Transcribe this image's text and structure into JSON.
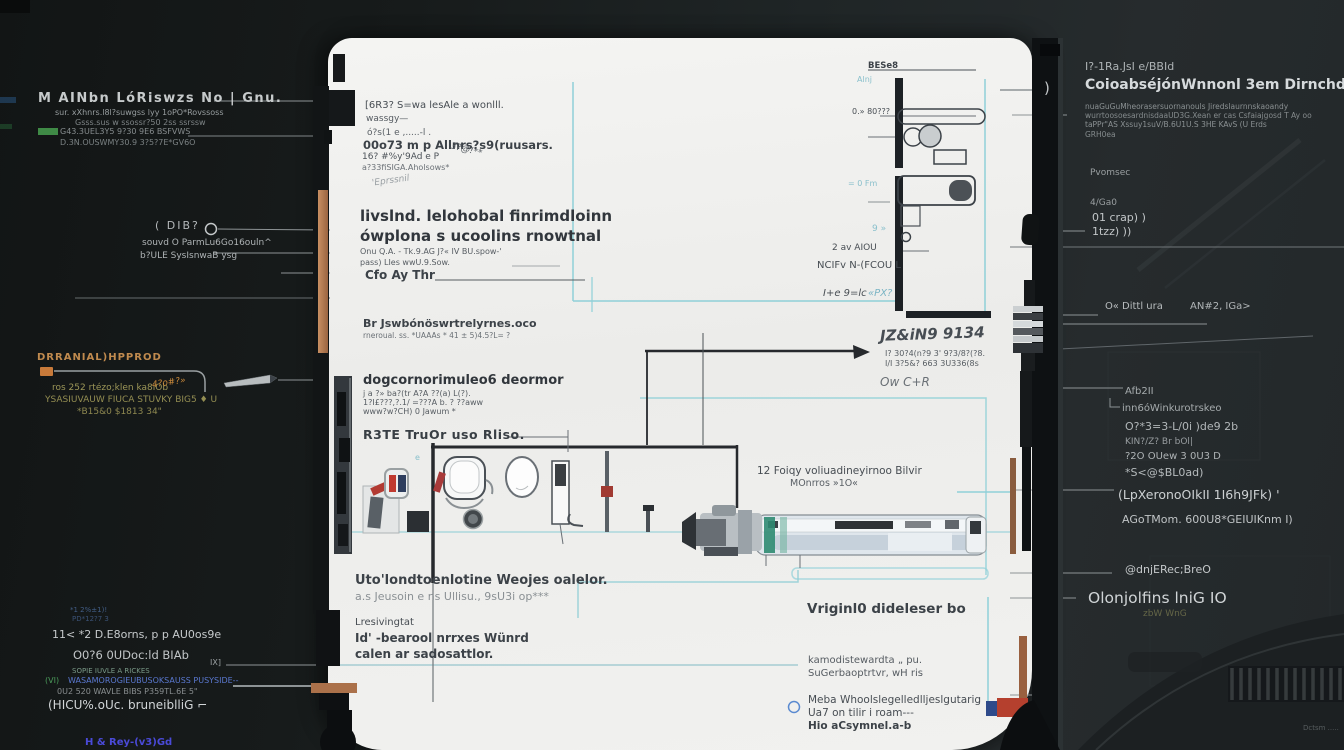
{
  "colors": {
    "background_dark": "#1a1e1f",
    "panel_white": "#f0f0ee",
    "cyan_accent": "#8fd0d8",
    "orange_accent": "#c87a3a",
    "copper": "#ab714a",
    "olive_text": "#948e52",
    "green_bar": "#3f8a46",
    "blue_link": "#5a78d0",
    "red_accent": "#b5402e",
    "blue_block": "#2e4a8a",
    "teal_machine": "#2f8b72"
  },
  "left": {
    "l1": "M AINbn LóRiswzs No | Gnu.",
    "l2a": "sur. xXhnrs.l8l?suwgss lyy 1oPO*Rovssoss",
    "l2b": "Gsss.sus w ssossr?50 2ss ssrssw",
    "l2c": "G43.3UEL3Y5 9?30 9E6 BSFVWS",
    "l2d": "D.3N.OUSWMY30.9 3?5?7E*GV6O",
    "l3": "( DIB?",
    "l4": "souvd O ParmLu6Go16ouln^",
    "l5": "b?ULE SysIsnwaB ysg",
    "l6": "DRRANIAL)HPPROD",
    "l8": "ros 252 rtézo;klen ka8iOb",
    "l8b": "4?o#?»",
    "l9": "YSASIUVAUW FIUCA STUVKY BIG5 ♦ U",
    "l10": "*B15&0 $1813 34\"",
    "l11a": "*1 2%±1)!",
    "l11b": "PD*12?7 3",
    "l12a": "11< *2 D.E8orns, p p AU0os9e",
    "l12b": "O0?6 0UDoc:ld BIAb",
    "l12c": "SOPIE IUVLE A RICKES",
    "l12d_prefix": "(VI)",
    "l12d": "WASAMOROGIEUBUSOKSAUSS PUSYSIDE--",
    "l12e": "0U2 520 WAVLE BIBS P359TL.6E 5\"",
    "l12f": "(HICU%.oUc.  bruneiblliG ⌐",
    "l12g": "H & Rey-(v3)Gd",
    "l_ix": "IX]"
  },
  "right": {
    "r1": "I?-1Ra.JsI e/BBId",
    "r2": "CoioabséjónWnnonl 3em Dirnchd mniexa",
    "r3a": "nuaGuGuMheorasersuornanouls Jiredslaurnnskaoandy",
    "r3b": "wurrtoosoesardnisdaaUD3G.Xean er cas Csfaiajgosd T Ay oo",
    "r3c": "taPPr\"AS Xssuy1suV/B.6U1U.S 3HE KAvS (U Erds",
    "r4": "GRH0ea",
    "r5": "Pvomsec",
    "r6": "4/Ga0",
    "r7a": "01 crap) )",
    "r7b": "1tzz) ))",
    "r_paren": ")",
    "r10a": "O« Dittl ura",
    "r10b": "AN#2, IGa>",
    "r11": "Afb2II",
    "r12": "inn6óWinkurotrskeo",
    "r13": "O?*3=3-L/0i )de9 2b",
    "r14": "KIN?/Z? Br bOl|",
    "r15": "?2O OUew 3 0U3 D",
    "r16": "*S<@$BL0ad)",
    "r17": "(LpXeronoOIkII 1I6h9JFk) '",
    "r18": "AGoTMom. 600U8*GEIUIKnm I)",
    "r19": "@dnjERec;BreO",
    "r20": "Olonjolfins lniG IO",
    "r21": "zbW WnG",
    "r22": "Dctsm ....."
  },
  "panel_labels": {
    "p1": "[6R3? S=wa lesAle a wonlll.",
    "p2": "wassgy—",
    "p3": "ó?s(1 e ,.....-l   .",
    "p4": "00o73 m p Allnrs?s9(ruusars.",
    "p4b": "3?@!**",
    "p5": "16? #%y'9Ad e   P",
    "p6": "a?33fiSIGA.Aholsows*",
    "p7": "'Eprssnil",
    "p8": "livslnd. lelohobal finrimdloinn",
    "p9": "ówplona s ucoolins rnowtnal",
    "p10": "Onu Q.A. - Tk.9.AG J?« IV BU.spow-'",
    "p11": "pass) LIes wwU.9.Sow.",
    "p12": "Cfo Ay Thr",
    "p13": "Br Jswbónöswrtrelyrnes.oco",
    "p14": "rneroual. ss. *UAAAs * 41 ± 5)4.5?L= ?",
    "p15": "dogcornorimuleo6 deormor",
    "p16": "j a ?» ba?(tr A?A    ??(a) L(?).",
    "p17": "1?I£???,?.1/ =???A b. ? ??aww",
    "p18": "www?w?CH) 0 Jawum *",
    "p19": "R3TE TruOr  uso  Rliso.",
    "p20": "Uto'londtoenlotine Weojes oalelor.",
    "p21": "a.s Jeusoin e ns Ullisu., 9sU3i op***",
    "p22": "Lresivingtat",
    "p23": "Id' -bearool nrrxes Wünrd",
    "p24": "calen ar sadosattlor.",
    "p25": "12   Foiqy voliuadineyirnoo Bilvir",
    "p26": "MOnrros »1O«",
    "p27": "JZ&iN9 9134",
    "p28": "I? 30?4(n?9 3' 9?3/8?(?8.",
    "p29": "I/I 3?5&? 663 3U336(8s",
    "p30": "Ow C+R",
    "p31": "BESe8",
    "p32": "Alnj",
    "p33": "0.» 80???",
    "p34": "2 av AIOU",
    "p35": "NCIFv N-(FCOU   L",
    "p36a": "I+e 9=lc",
    "p36b": "«PX?",
    "p37": "= 0 Fm",
    "p38": "9 »",
    "p39": "Vriginl0 dideleser bo",
    "p40": "kamodistewardta   „ pu.",
    "p41": "SuGerbaoptrtvr, wH ris",
    "p42": "Meba Whoolslegelledlljeslgutarig",
    "p43": "Ua7 on tilir i roam---",
    "p44": "Hio aCsymnel.a-b",
    "p_e": "e"
  },
  "icons": {
    "pen_icon": "needle/pen pointer shape",
    "target_circle_icon": "small hollow circle callout",
    "arrow_icon": "right-pointing leader arrow",
    "ring_icon": "blue ring bullet",
    "coupler_icon": "ribbed shaft coupler on panel edge",
    "green_bar_icon": "small green highlight bar",
    "orange_tab_icon": "orange callout tab"
  }
}
